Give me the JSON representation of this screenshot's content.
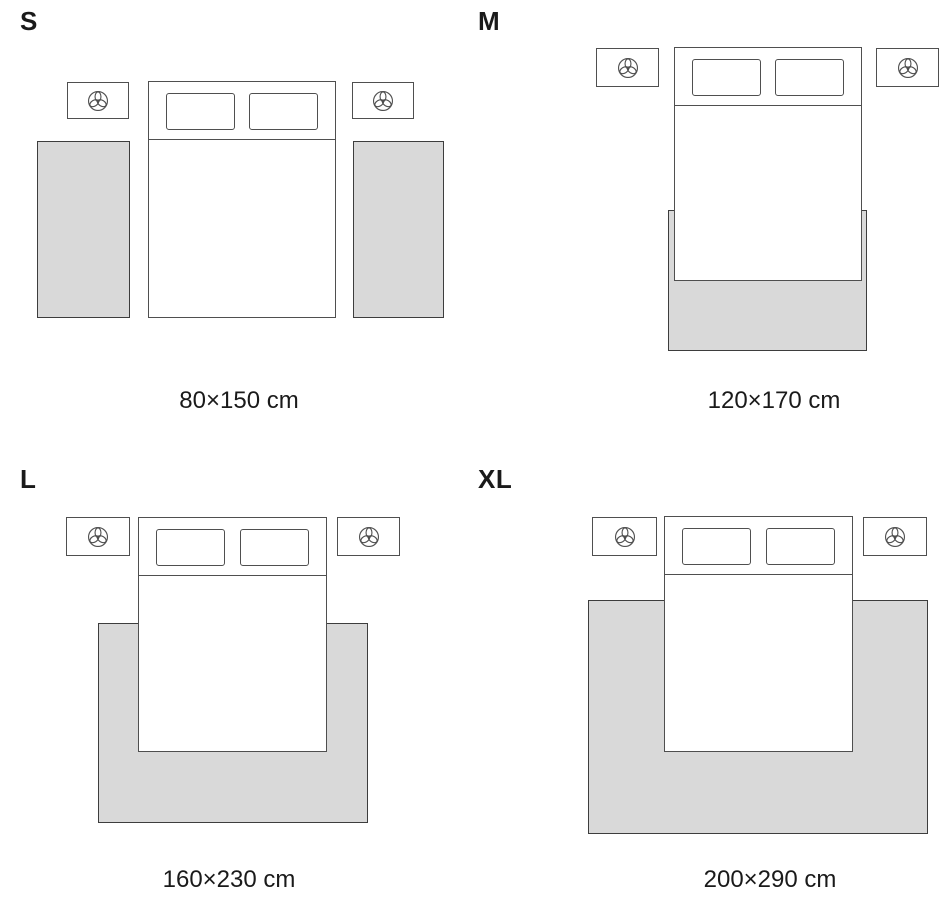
{
  "colors": {
    "bg": "#ffffff",
    "text": "#1a1a1a",
    "line": "#4f4f4f",
    "rug-border": "#3d3d3d",
    "rug-fill": "#d9d9d9",
    "bed-fill": "#ffffff"
  },
  "icons": {
    "nightstand_decoration": "plant-top-view-icon"
  },
  "sizes": [
    {
      "label": "S",
      "dimensions": "80×150 cm"
    },
    {
      "label": "M",
      "dimensions": "120×170 cm"
    },
    {
      "label": "L",
      "dimensions": "160×230 cm"
    },
    {
      "label": "XL",
      "dimensions": "200×290 cm"
    }
  ]
}
